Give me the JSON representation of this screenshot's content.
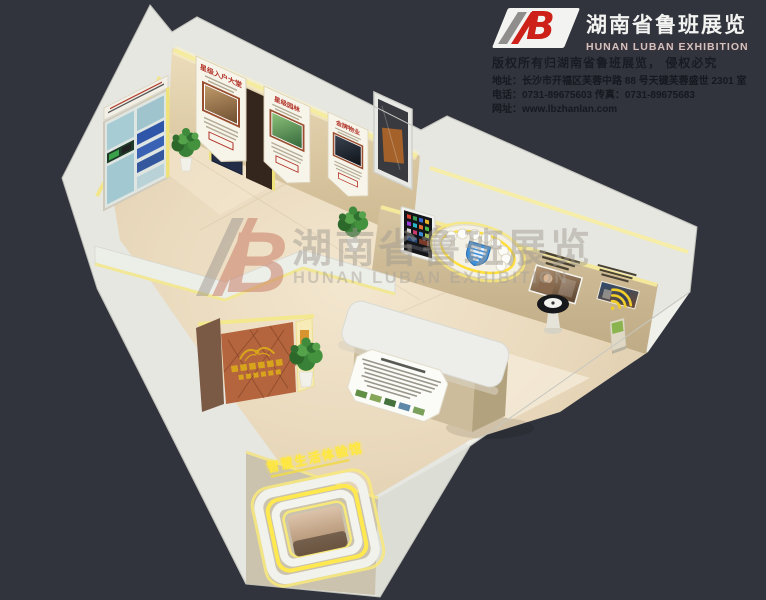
{
  "header": {
    "logo_letter": "B",
    "company_cn": "湖南省鲁班展览",
    "company_en": "HUNAN LUBAN EXHIBITION"
  },
  "contact": {
    "copyright": "版权所有归湖南省鲁班展览， 侵权必究",
    "address": "地址：长沙市开福区芙蓉中路 88 号天键芙蓉盛世 2301 室",
    "phone_fax": "电话：0731-89675603   传真：0731-89675683",
    "website": "网址：www.lbzhanlan.com"
  },
  "watermark": {
    "logo_letter": "B",
    "company_cn": "湖南省鲁班展览",
    "company_en": "HUNAN LUBAN EXHIBITION"
  },
  "hall": {
    "posters": [
      {
        "title": "星级入户大堂"
      },
      {
        "title": "星级园林"
      },
      {
        "title": "金牌物业"
      }
    ],
    "entrance_sign": "智慧生活体验馆"
  },
  "colors": {
    "background": "#31343d",
    "accent_red": "#cc2018",
    "led_yellow": "#ffe94f",
    "wall_white": "#e7e8e3",
    "floor_beige": "#e8d8bc",
    "gold": "#d8a41c",
    "shield_blue": "#3f8fd9"
  }
}
